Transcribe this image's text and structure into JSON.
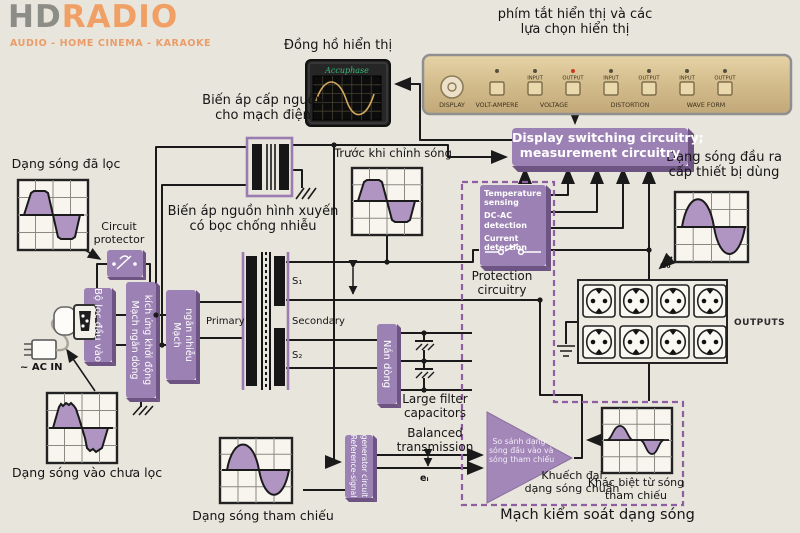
{
  "logo": {
    "hd": "HD",
    "radio": "RADIO",
    "tagline": "AUDIO - HOME CINEMA - KARAOKE"
  },
  "meter": {
    "label": "Đồng hồ hiển thị",
    "brand": "Accuphase"
  },
  "panel": {
    "label_line1": "phím tắt hiển thị và các",
    "label_line2": "lựa chọn hiển thị",
    "knob_label": "DISPLAY",
    "button_tops": [
      "INPUT",
      "OUTPUT",
      "INPUT",
      "OUTPUT",
      "INPUT",
      "OUTPUT"
    ],
    "groups": [
      "VOLT-AMPERE",
      "VOLTAGE",
      "DISTORTION",
      "WAVE FORM"
    ]
  },
  "labels": {
    "supply_transformer_1": "Biến áp cấp nguồn",
    "supply_transformer_2": "cho mạch điện",
    "filtered_wave": "Dạng sóng đã lọc",
    "circuit_protector_1": "Circuit",
    "circuit_protector_2": "protector",
    "main_transformer_1": "Biến áp nguồn hình xuyến",
    "main_transformer_2": "có bọc chống nhiễu",
    "before_correction": "Trước khi chỉnh sóng",
    "display_box_1": "Display switching circuitry;",
    "display_box_2": "measurement circuitry",
    "output_wave_1": "Dạng sóng  đầu ra",
    "output_wave_2": "cấp thiết bị dùng",
    "temp_1": "Temperature sensing",
    "temp_2": "DC-AC detection",
    "temp_3": "Current detection",
    "protection_1": "Protection",
    "protection_2": "circuitry",
    "outputs": "OUTPUTS",
    "e0": "e₀",
    "ei": "eᵢ",
    "s1": "S₁",
    "s2": "S₂",
    "primary": "Primary",
    "secondary": "Secondary",
    "input_filter": "Bộ lọc đầu vào",
    "inrush_1": "Mạch ngăn dòng",
    "inrush_2": "kích ứng khởi động",
    "noise_1": "Mạch",
    "noise_2": "ngăn nhiễu",
    "rectifier": "Nắn dòng",
    "caps_1": "Large filter",
    "caps_2": "capacitors",
    "balanced_1": "Balanced",
    "balanced_2": "transmission",
    "refgen_1": "Reference-signal",
    "refgen_2": "generator circuit",
    "amp_1": "So sánh dạng",
    "amp_2": "sóng đầu vào và",
    "amp_3": "sóng tham chiếu",
    "amplify_1": "Khuếch đại",
    "amplify_2": "dạng sóng chuẩn",
    "diff_1": "Khác biệt từ sóng",
    "diff_2": "tham chiếu",
    "control_circuit": "Mạch kiểm soát dạng sóng",
    "reference_wave": "Dạng sóng tham chiếu",
    "unfiltered_wave": "Dạng sóng vào chưa lọc",
    "ac_in": "~ AC IN"
  },
  "colors": {
    "purple": "#9c81b4",
    "purple_dark": "#6e5482",
    "wave_fill": "#b094c2",
    "dashed": "#8e5ea2",
    "wire": "#1a1a1a",
    "panel_tan": "#d8c398",
    "logo_orange": "#f0a065"
  }
}
